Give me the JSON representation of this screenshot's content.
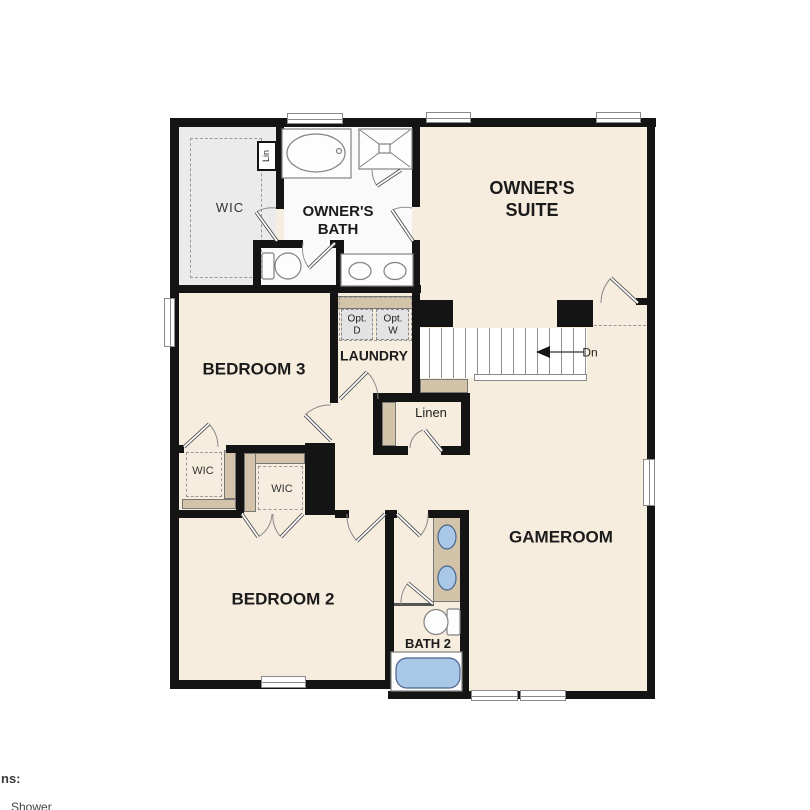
{
  "plan": {
    "type": "second-floor residential floor plan",
    "rooms": {
      "wic_main": {
        "label": "WIC"
      },
      "lin_closet": {
        "label": "Lin"
      },
      "owners_bath": {
        "label_line1": "OWNER'S",
        "label_line2": "BATH"
      },
      "owners_suite": {
        "label_line1": "OWNER'S",
        "label_line2": "SUITE"
      },
      "bedroom3": {
        "label": "BEDROOM 3"
      },
      "laundry": {
        "label": "LAUNDRY",
        "opt_dryer_line1": "Opt.",
        "opt_dryer_line2": "D",
        "opt_washer_line1": "Opt.",
        "opt_washer_line2": "W"
      },
      "stairs": {
        "direction_label": "Dn"
      },
      "linen": {
        "label": "Linen"
      },
      "wic_bedroom3": {
        "label": "WIC"
      },
      "wic_bedroom2": {
        "label": "WIC"
      },
      "bedroom2": {
        "label": "BEDROOM 2"
      },
      "bath2": {
        "label": "BATH 2"
      },
      "gameroom": {
        "label": "GAMEROOM"
      }
    },
    "colors": {
      "wall": "#141414",
      "floor_cream": "#f6edde",
      "floor_gray": "#ebebeb",
      "floor_white": "#fafafa",
      "casework_tan": "#d3c4a9",
      "fixture_blue": "#a9c7e7"
    }
  },
  "legend_partial": {
    "heading_fragment": "ns:",
    "item_fragment": "Shower"
  }
}
